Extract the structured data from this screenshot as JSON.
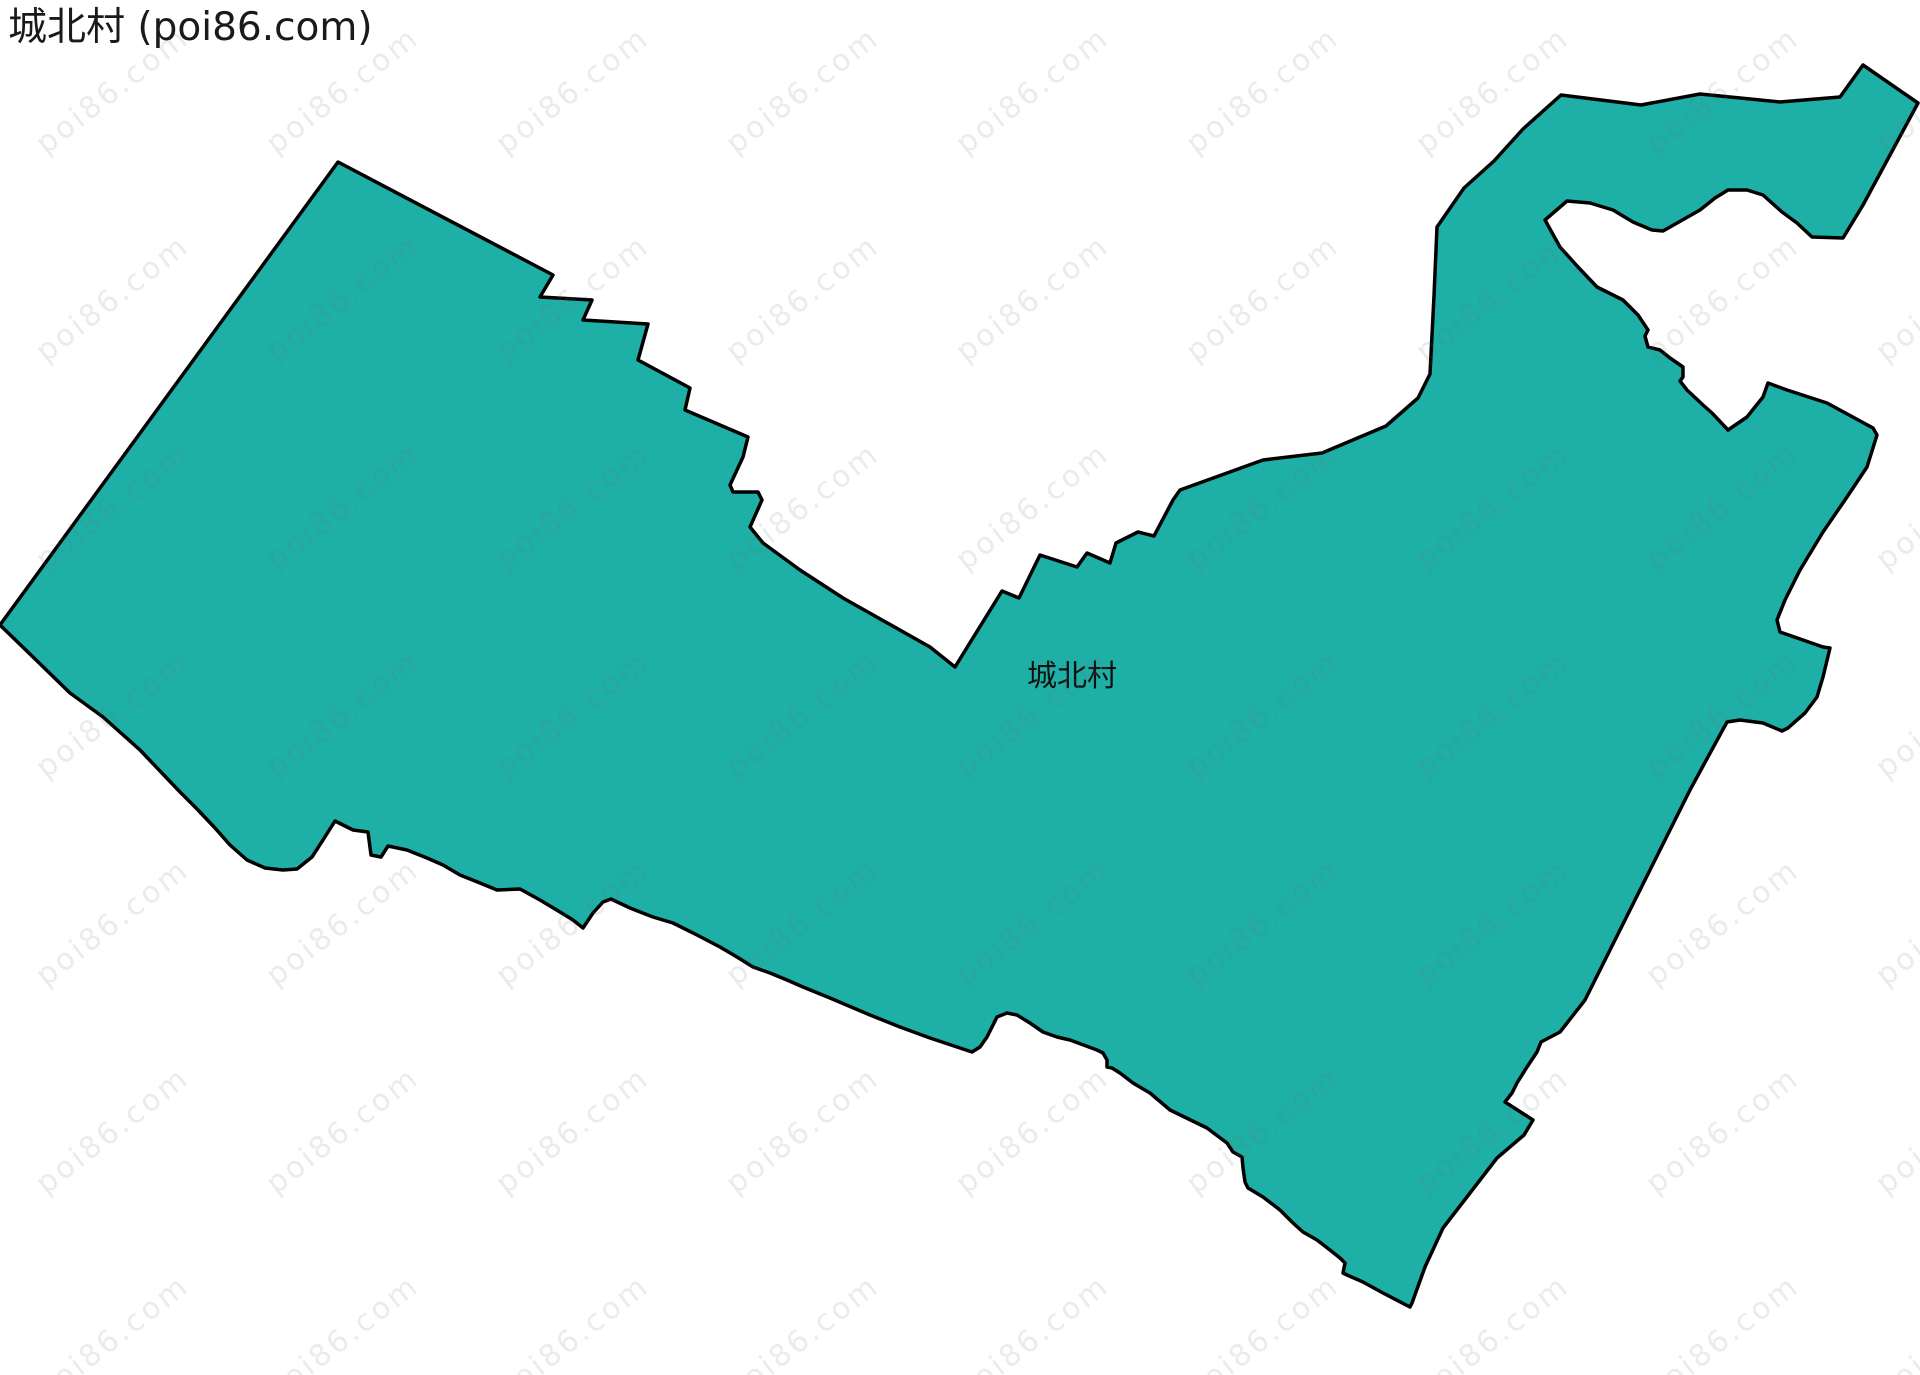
{
  "page": {
    "title": "城北村 (poi86.com)",
    "background_color": "#ffffff"
  },
  "map": {
    "shape": {
      "name": "城北村",
      "fill_color": "#1eb0a6",
      "stroke_color": "#000000",
      "stroke_width": 3.5,
      "points": "338,162 553,275 540,297 592,300 583,320 648,324 638,360 690,388 685,410 748,437 743,457 730,485 733,492 758,492 762,500 750,527 763,543 800,570 843,598 930,647 955,667 1002,591 1019,598 1040,555 1077,567 1087,553 1110,563 1116,543 1138,532 1154,536 1173,500 1180,490 1263,460 1322,453 1386,426 1418,398 1430,374 1434,296 1437,227 1464,188 1494,161 1523,129 1561,95 1641,105 1700,94 1780,102 1840,97 1863,65 1918,103 1897,142 1863,205 1843,238 1812,237 1797,223 1782,212 1763,195 1747,190 1728,190 1715,198 1700,210 1663,231 1652,230 1633,222 1613,210 1590,203 1567,201 1545,220 1560,247 1578,267 1597,287 1623,300 1638,315 1648,330 1645,336 1648,347 1660,350 1670,358 1683,367 1683,377 1680,381 1687,390 1703,405 1712,413 1728,430 1747,417 1763,397 1768,383 1787,390 1827,403 1873,428 1877,435 1867,467 1847,497 1823,532 1800,570 1785,600 1777,620 1780,632 1803,640 1823,647 1830,648 1823,677 1817,697 1805,713 1797,720 1788,728 1782,731 1763,723 1740,720 1727,722 1690,790 1655,860 1620,930 1585,1000 1560,1032 1541,1042 1537,1052 1527,1067 1517,1083 1512,1093 1505,1102 1533,1120 1524,1135 1497,1158 1470,1193 1443,1228 1425,1267 1412,1303 1410,1307 1383,1293 1363,1282 1347,1275 1343,1273 1345,1263 1340,1258 1330,1250 1317,1240 1303,1232 1293,1223 1280,1210 1263,1197 1248,1188 1245,1182 1243,1168 1242,1157 1233,1152 1227,1143 1207,1128 1170,1110 1150,1093 1133,1083 1120,1073 1112,1068 1107,1067 1107,1060 1103,1053 1097,1050 1070,1040 1057,1037 1043,1032 1030,1023 1017,1015 1007,1013 997,1017 987,1037 980,1047 972,1052 957,1047 930,1038 900,1027 870,1015 830,998 803,987 787,980 770,973 753,967 737,957 720,947 697,935 673,923 653,917 630,908 611,899 603,902 593,913 583,928 573,920 560,912 540,900 520,889 497,890 480,883 460,875 443,865 427,858 407,850 388,846 381,857 371,855 368,832 353,830 335,821 323,840 312,857 297,869 283,870 265,868 247,860 230,845 215,828 198,810 180,792 140,750 103,717 70,693 33,657 0,625"
    },
    "label": {
      "text": "城北村",
      "x": 1072,
      "y": 686,
      "font_size": 30,
      "color": "#111111"
    }
  },
  "watermark": {
    "text": "poi86.com",
    "color": "rgba(110,110,110,0.14)",
    "font_size": 30,
    "rotation_deg": -38,
    "grid": {
      "x_start": 40,
      "y_start": 130,
      "x_step": 230,
      "y_step": 208,
      "cols": 9,
      "rows": 7
    }
  }
}
